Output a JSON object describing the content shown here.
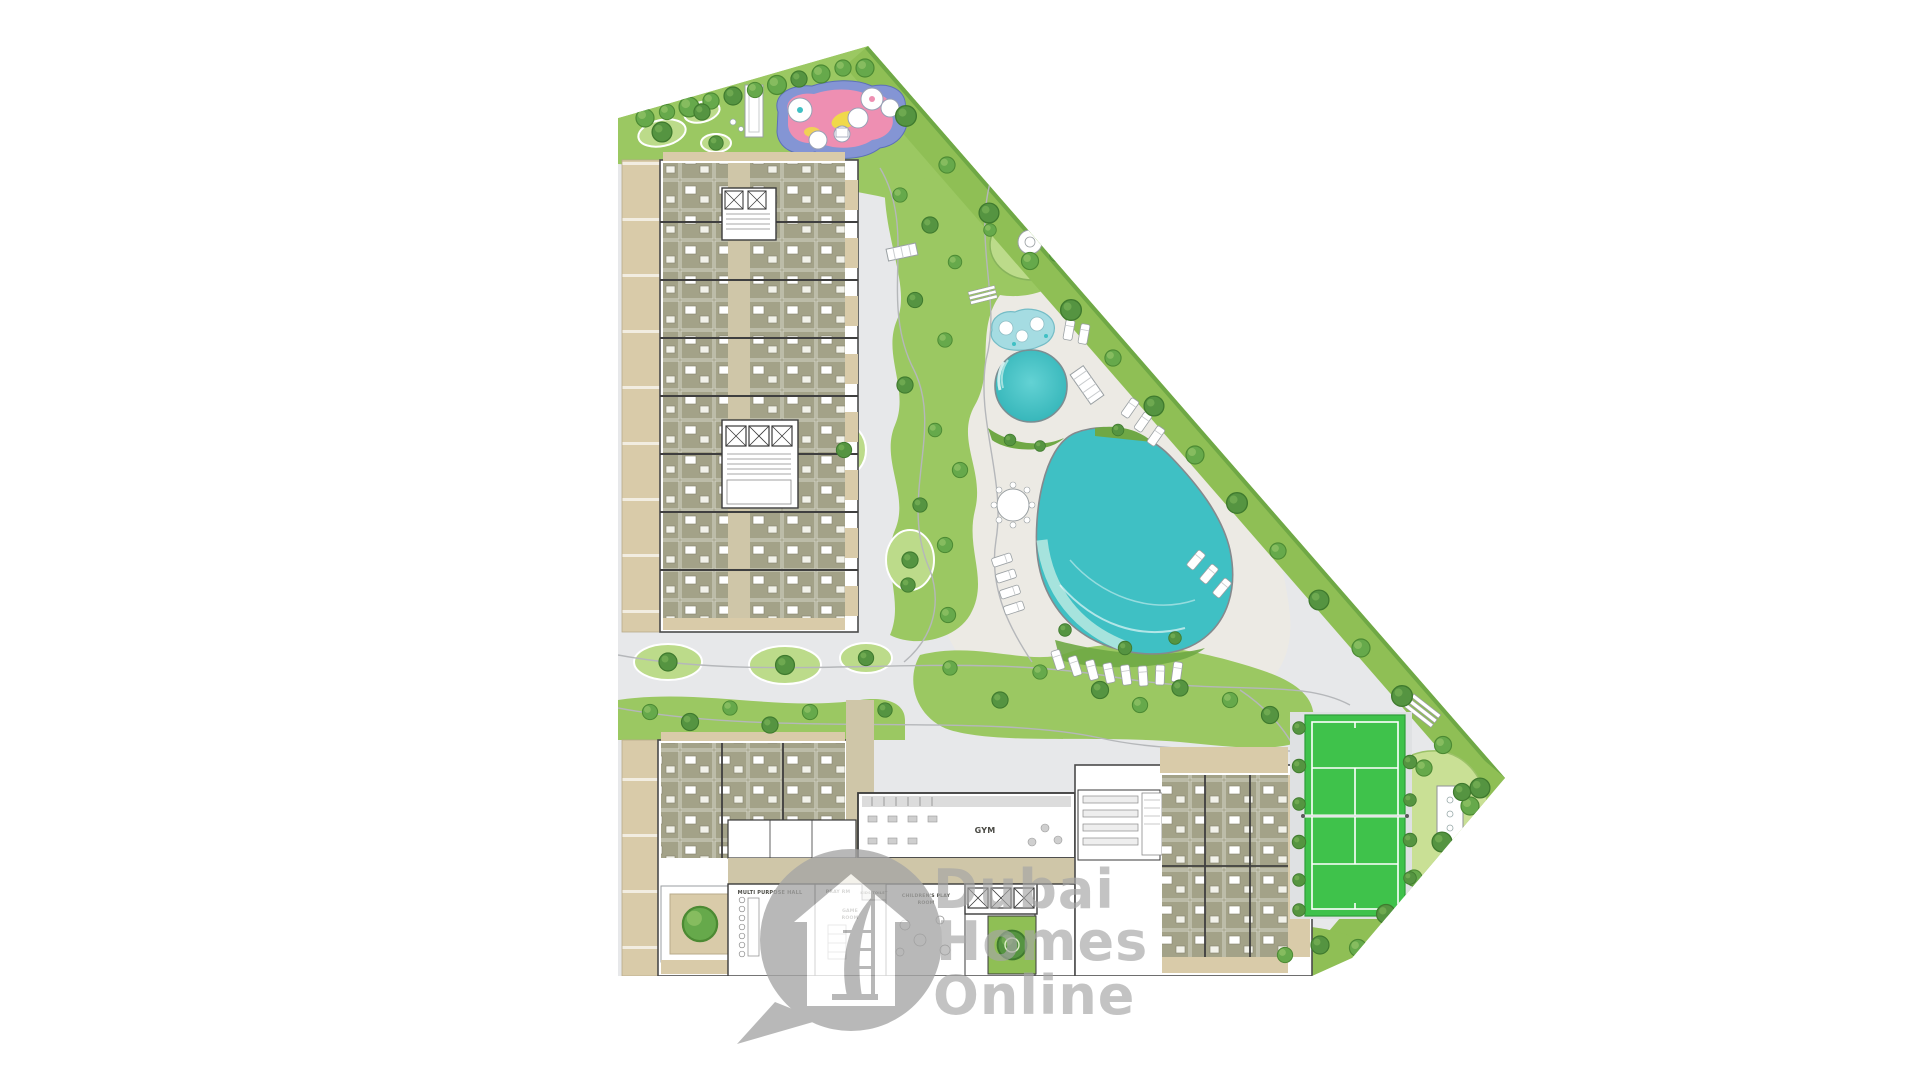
{
  "watermark": {
    "line1": "Dubai",
    "line2": "Homes",
    "line3": "Online"
  },
  "labels": {
    "gym": "GYM",
    "multi_purpose_hall": "MULTI PURPOSE HALL",
    "pray_room": "PRAY RM",
    "kids_toilet": "KIDS TOILET",
    "game_room_line1": "GAME",
    "game_room_line2": "ROOM",
    "childrens_play_line1": "CHILDREN'S PLAY",
    "childrens_play_line2": "ROOM"
  },
  "colors": {
    "grass": "#9BC862",
    "grass_light": "#BCDB8A",
    "grass_dark": "#6FA845",
    "pavement": "#E7E8EA",
    "deck": "#ECEAE4",
    "terrace": "#D9CBA9",
    "room": "#A3A288",
    "corridor": "#CFC6A8",
    "pool": "#3FC0C4",
    "pool_kids": "#A5DCE2",
    "tennis": "#3FC24B",
    "play_pink": "#EE8FB2",
    "play_blue": "#8495D4",
    "play_yellow": "#F0D94A",
    "watermark": "#A5A5A5"
  }
}
